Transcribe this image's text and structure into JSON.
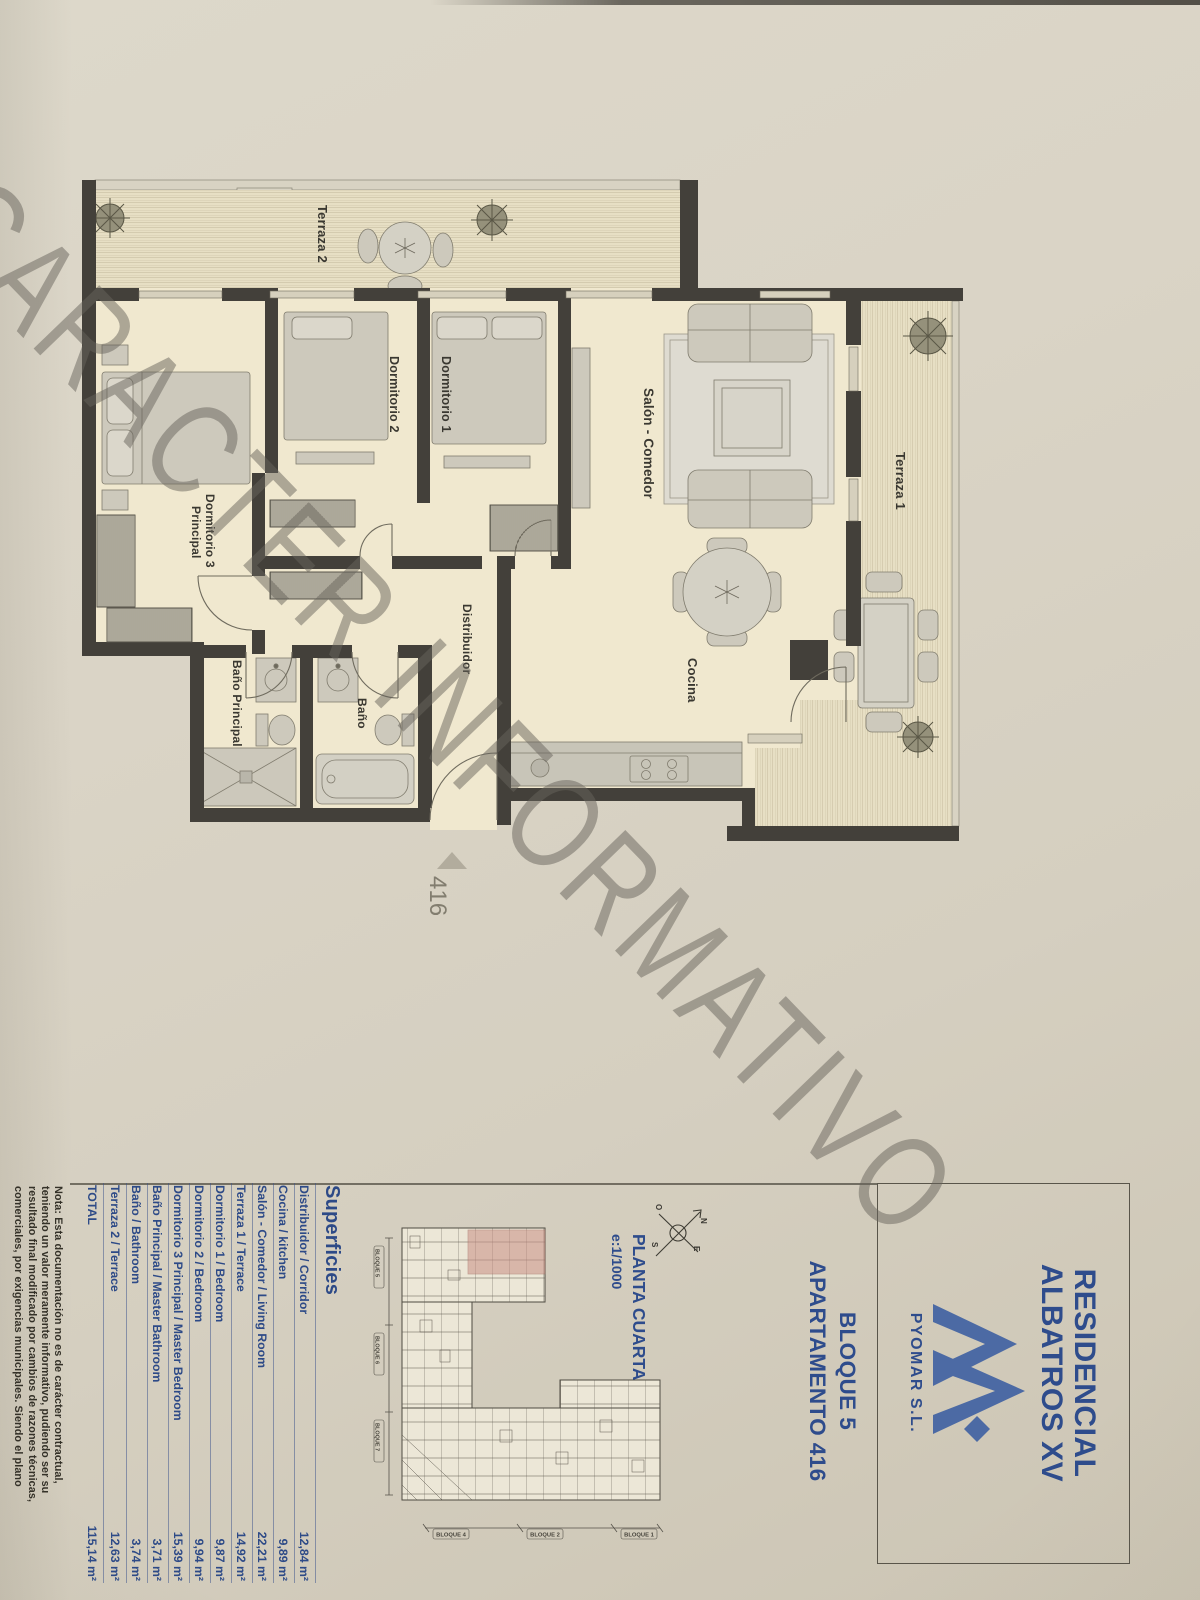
{
  "watermark": "CARACTER INFORMATIVO",
  "plan": {
    "rooms": {
      "terraza2": "Terraza 2",
      "dormitorio2": "Dormitorio 2",
      "dormitorio1": "Dormitorio 1",
      "salon": "Salón - Comedor",
      "terraza1": "Terraza 1",
      "dormitorio3_line1": "Dormitorio 3",
      "dormitorio3_line2": "Principal",
      "distribuidor": "Distribuidor",
      "bano_principal": "Baño Principal",
      "bano": "Baño",
      "cocina": "Cocina"
    },
    "entrance_label": "416"
  },
  "sidebar": {
    "project": {
      "line1": "RESIDENCIAL",
      "line2": "ALBATROS XV",
      "company": "PYOMAR S.L."
    },
    "unit": {
      "line1": "BLOQUE 5",
      "line2": "APARTAMENTO 416"
    },
    "floor": {
      "name": "PLANTA CUARTA",
      "scale": "e:1/1000"
    },
    "compass": {
      "n": "N",
      "s": "S",
      "e": "E",
      "w": "O"
    },
    "site_plan": {
      "bottom_labels": [
        "BLOQUE 4",
        "BLOQUE 2",
        "BLOQUE 1"
      ],
      "side_labels": [
        "BLOQUE 5",
        "BLOQUE 6",
        "BLOQUE 7"
      ],
      "highlight_color": "#c98f85"
    },
    "areas": {
      "header": "Superficies",
      "rows": [
        {
          "label": "Distribuidor / Corridor",
          "value": "12,84 m²"
        },
        {
          "label": "Cocina / kitchen",
          "value": "9,89 m²"
        },
        {
          "label": "Salón - Comedor / Living Room",
          "value": "22,21 m²"
        },
        {
          "label": "Terraza 1 / Terrace",
          "value": "14,92 m²"
        },
        {
          "label": "Dormitorio 1 / Bedroom",
          "value": "9,87 m²"
        },
        {
          "label": "Dormitorio 2 / Bedroom",
          "value": "9,94 m²"
        },
        {
          "label": "Dormitorio 3 Principal / Master Bedroom",
          "value": "15,39 m²"
        },
        {
          "label": "Baño Principal / Master Bathroom",
          "value": "3,71 m²"
        },
        {
          "label": "Baño / Bathroom",
          "value": "3,74 m²"
        },
        {
          "label": "Terraza 2 / Terrace",
          "value": "12,63 m²"
        }
      ],
      "total": {
        "label": "TOTAL",
        "value": "115,14 m²"
      }
    },
    "note_lines": [
      "Nota: Esta documentación no es de carácter contractual,",
      "teniendo un valor meramente informativo, pudiendo ser su",
      "resultado final modificado por cambios de razones técnicas,",
      "comerciales, por exigencias municipales. Siendo el plano"
    ]
  },
  "colors": {
    "accent_blue": "#2e4c8c",
    "paper": "#d9d3c4",
    "wall": "#43403a",
    "room_fill": "#f0e8cf",
    "highlight": "#c98f85"
  }
}
